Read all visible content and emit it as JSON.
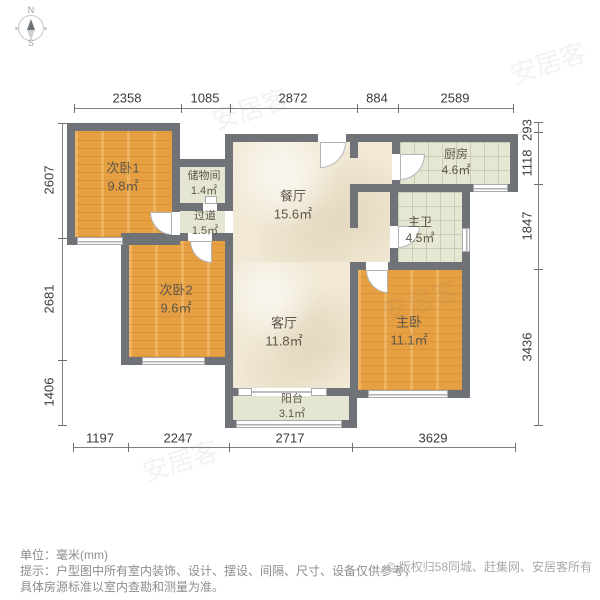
{
  "compass": {
    "north_label": "N",
    "south_label": "S"
  },
  "dimensions_mm": {
    "top": [
      "2358",
      "1085",
      "2872",
      "884",
      "2589"
    ],
    "bottom": [
      "1197",
      "2247",
      "2717",
      "3629"
    ],
    "left": [
      "2607",
      "2681",
      "1406"
    ],
    "right": [
      "293",
      "1118",
      "1847",
      "3436"
    ]
  },
  "rooms": [
    {
      "id": "bedroom1",
      "name": "次卧1",
      "area": "9.8㎡"
    },
    {
      "id": "storage",
      "name": "储物间",
      "area": "1.4㎡"
    },
    {
      "id": "hallway",
      "name": "过道",
      "area": "1.5㎡"
    },
    {
      "id": "bedroom2",
      "name": "次卧2",
      "area": "9.6㎡"
    },
    {
      "id": "dining",
      "name": "餐厅",
      "area": "15.6㎡"
    },
    {
      "id": "kitchen",
      "name": "厨房",
      "area": "4.6㎡"
    },
    {
      "id": "bath",
      "name": "主卫",
      "area": "4.5㎡"
    },
    {
      "id": "living",
      "name": "客厅",
      "area": "11.8㎡"
    },
    {
      "id": "master",
      "name": "主卧",
      "area": "11.1㎡"
    },
    {
      "id": "balcony",
      "name": "阳台",
      "area": "3.1㎡"
    }
  ],
  "footer": {
    "unit_line": "单位：毫米(mm)",
    "tip_line1": "提示：户型图中所有室内装饰、设计、摆设、间隔、尺寸、设备仅供参考，",
    "tip_line2": "具体房源标准以室内查勘和测量为准。",
    "copyright": "© 版权归58同城、赶集网、安居客所有"
  },
  "watermark": "安居客",
  "colors": {
    "wall": "#6f7276",
    "wood_floor": "#e69f41",
    "tile_floor": "#e6e7d3",
    "cream_floor": "#f1e9d6"
  }
}
